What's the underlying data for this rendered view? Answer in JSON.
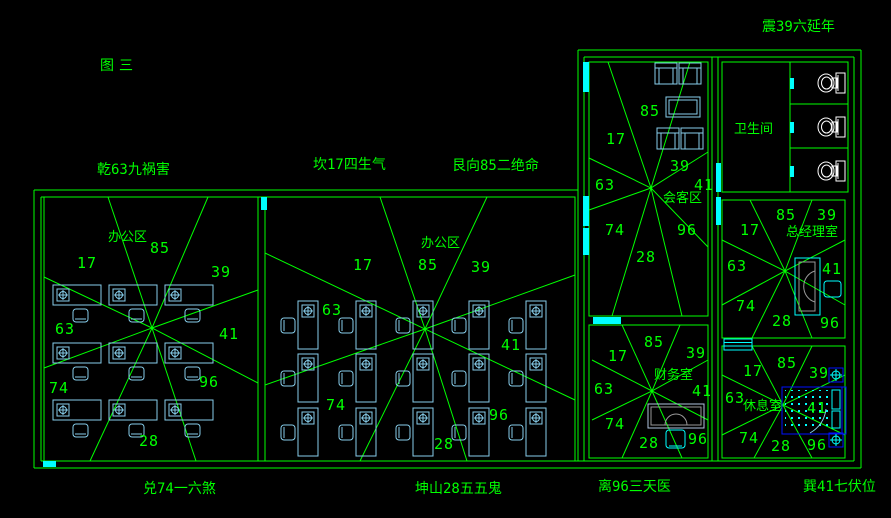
{
  "figure_label": "图三",
  "compass": {
    "zhen": "震39六延年",
    "qian": "乾63九祸害",
    "kan": "坎17四生气",
    "gen": "艮向85二绝命",
    "dui": "兑74一六煞",
    "kun": "坤山28五五鬼",
    "li": "离96三天医",
    "xun": "巽41七伏位"
  },
  "rooms": {
    "office_left": {
      "label": "办公区",
      "numbers": {
        "n": "85",
        "nw": "17",
        "ne": "39",
        "w": "63",
        "e": "41",
        "sw": "74",
        "se": "96",
        "s": "28"
      }
    },
    "office_mid": {
      "label": "办公区",
      "numbers": {
        "n": "85",
        "nw": "17",
        "ne": "39",
        "w": "63",
        "e": "41",
        "sw": "74",
        "se": "96",
        "s": "28"
      }
    },
    "meeting": {
      "label": "会客区",
      "numbers": {
        "n": "85",
        "nw": "17",
        "ne": "39",
        "w": "63",
        "e": "41",
        "sw": "74",
        "se": "96",
        "s": "28"
      }
    },
    "bathroom": {
      "label": "卫生间"
    },
    "manager": {
      "label": "总经理室",
      "numbers": {
        "n": "85",
        "nw": "17",
        "ne": "39",
        "w": "63",
        "e": "41",
        "sw": "74",
        "se": "96",
        "s": "28"
      }
    },
    "finance": {
      "label": "财务室",
      "numbers": {
        "n": "85",
        "nw": "17",
        "ne": "39",
        "w": "63",
        "e": "41",
        "sw": "74",
        "se": "96",
        "s": "28"
      }
    },
    "rest": {
      "label": "休息室",
      "numbers": {
        "n": "85",
        "nw": "17",
        "ne": "39",
        "w": "63",
        "e": "41",
        "sw": "74",
        "se": "96",
        "s": "28"
      }
    }
  },
  "colors": {
    "background": "#000000",
    "wall_line": "#00ff00",
    "text": "#00ff00",
    "furniture": "#87ceeb",
    "accent": "#00ffff",
    "bed": "#0011ff",
    "fixture": "#ffffff"
  }
}
